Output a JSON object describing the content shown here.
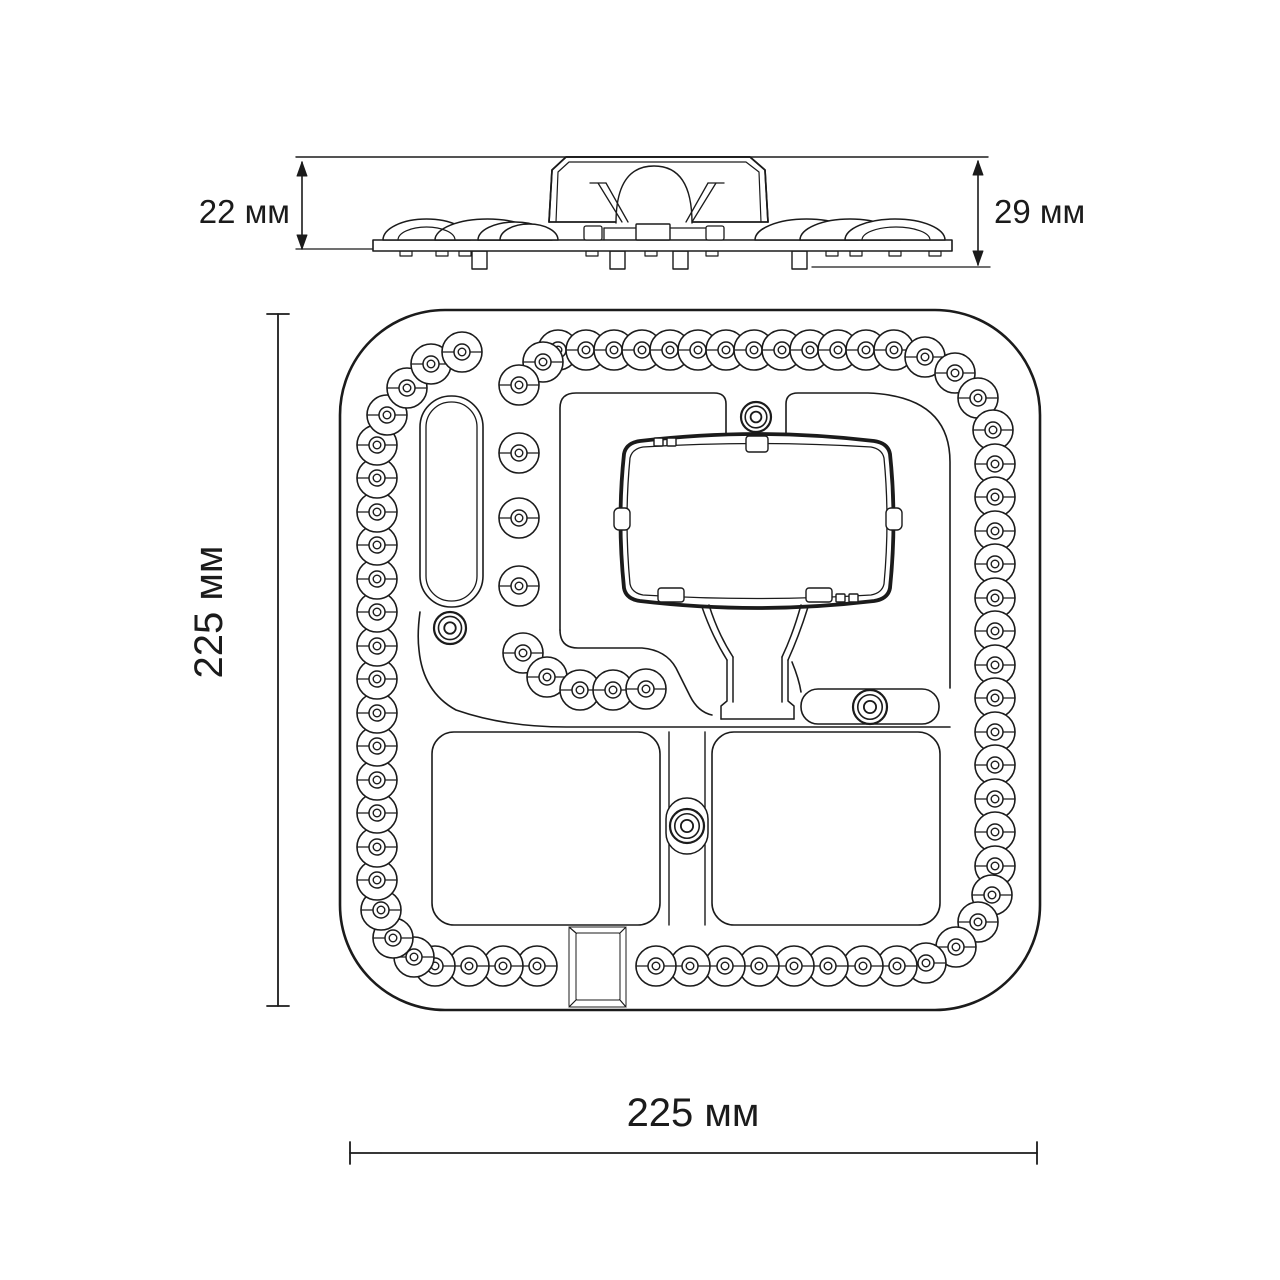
{
  "labels": {
    "side_height_left": "22 мм",
    "side_height_right": "29 мм",
    "plan_height": "225 мм",
    "plan_width": "225 мм"
  },
  "colors": {
    "line": "#1b1b1b",
    "background": "#ffffff"
  },
  "geometry": {
    "canvas": {
      "w": 1280,
      "h": 1280
    },
    "side_view": {
      "ext_top": [
        296,
        157,
        988,
        157
      ],
      "plate": [
        373,
        240,
        579,
        11
      ],
      "dome_base_y": 240,
      "domes": [
        [
          383,
          470,
          21
        ],
        [
          435,
          540,
          21
        ],
        [
          478,
          552,
          18
        ],
        [
          500,
          558,
          16
        ],
        [
          755,
          858,
          21
        ],
        [
          800,
          900,
          21
        ],
        [
          845,
          945,
          21
        ]
      ],
      "dome_details": [
        [
          398,
          455,
          13
        ],
        [
          862,
          930,
          13
        ]
      ],
      "housing_outer": "M 549,222 L 552,170 L 566,157 L 750,157 L 765,170 L 768,222",
      "housing_inner": "M 556,222 L 558,172 L 569,162 L 746,162 L 759,172 L 761,222",
      "housing_dome": "M 616,223 Q 616,166 654,166 Q 692,166 692,223",
      "holder_lines": [
        "M 598,183 L 622,222",
        "M 606,183 L 628,222",
        "M 716,183 L 692,222",
        "M 708,183 L 686,222",
        "M 590,183 L 606,183",
        "M 708,183 L 724,183"
      ],
      "base_box": [
        636,
        224,
        34,
        16
      ],
      "base_lines": [
        "M 604,228 L 636,228",
        "M 670,228 L 710,228",
        "M 604,228 L 604,240",
        "M 710,228 L 710,240"
      ],
      "base_clips": [
        [
          584,
          226,
          18,
          14
        ],
        [
          706,
          226,
          18,
          14
        ]
      ],
      "pins": [
        472,
        610,
        673,
        792
      ],
      "pin": {
        "w": 15,
        "h": 18,
        "y": 251
      },
      "feet": [
        400,
        436,
        459,
        586,
        645,
        706,
        826,
        850,
        889,
        929
      ],
      "foot": {
        "w": 12,
        "h": 5,
        "y": 251
      },
      "dim_left": {
        "x": 302,
        "y1": 162,
        "y2": 249,
        "ext": [
          296,
          249,
          372,
          249
        ],
        "lx": 290,
        "ly": 223
      },
      "dim_right": {
        "x": 978,
        "y1": 161,
        "y2": 265,
        "ext": [
          812,
          267,
          990,
          267
        ],
        "lx": 994,
        "ly": 223
      }
    },
    "top_view": {
      "board": [
        340,
        310,
        700,
        700,
        105
      ],
      "led": {
        "r": 20,
        "ring_r": 8,
        "dot_r": 3.8
      },
      "ring_leds": [
        [
          558,
          350
        ],
        [
          586,
          350
        ],
        [
          614,
          350
        ],
        [
          642,
          350
        ],
        [
          670,
          350
        ],
        [
          698,
          350
        ],
        [
          726,
          350
        ],
        [
          754,
          350
        ],
        [
          782,
          350
        ],
        [
          810,
          350
        ],
        [
          838,
          350
        ],
        [
          866,
          350
        ],
        [
          894,
          350
        ],
        [
          925,
          357
        ],
        [
          955,
          373
        ],
        [
          978,
          398
        ],
        [
          993,
          430
        ],
        [
          995,
          464
        ],
        [
          995,
          497
        ],
        [
          995,
          531
        ],
        [
          995,
          564
        ],
        [
          995,
          598
        ],
        [
          995,
          631
        ],
        [
          995,
          665
        ],
        [
          995,
          698
        ],
        [
          995,
          732
        ],
        [
          995,
          765
        ],
        [
          995,
          799
        ],
        [
          995,
          832
        ],
        [
          995,
          866
        ],
        [
          992,
          895
        ],
        [
          978,
          922
        ],
        [
          956,
          947
        ],
        [
          926,
          963
        ],
        [
          897,
          966
        ],
        [
          863,
          966
        ],
        [
          828,
          966
        ],
        [
          794,
          966
        ],
        [
          759,
          966
        ],
        [
          725,
          966
        ],
        [
          690,
          966
        ],
        [
          656,
          966
        ],
        [
          537,
          966
        ],
        [
          503,
          966
        ],
        [
          469,
          966
        ],
        [
          435,
          966
        ],
        [
          414,
          957
        ],
        [
          393,
          938
        ],
        [
          381,
          910
        ],
        [
          377,
          880
        ],
        [
          377,
          847
        ],
        [
          377,
          813
        ],
        [
          377,
          780
        ],
        [
          377,
          746
        ],
        [
          377,
          713
        ],
        [
          377,
          679
        ],
        [
          377,
          646
        ],
        [
          377,
          612
        ],
        [
          377,
          579
        ],
        [
          377,
          545
        ],
        [
          377,
          512
        ],
        [
          377,
          478
        ],
        [
          377,
          445
        ],
        [
          387,
          415
        ],
        [
          407,
          388
        ],
        [
          431,
          364
        ],
        [
          462,
          352
        ]
      ],
      "inner_leds": [
        [
          543,
          362
        ],
        [
          519,
          385
        ],
        [
          519,
          453
        ],
        [
          519,
          518
        ],
        [
          519,
          586
        ],
        [
          523,
          653
        ],
        [
          547,
          677
        ],
        [
          580,
          690
        ],
        [
          613,
          690
        ],
        [
          646,
          689
        ]
      ],
      "stadium_outer": [
        420,
        396,
        63,
        211,
        31
      ],
      "stadium_inner": [
        426,
        402,
        51,
        199,
        25
      ],
      "island_paths": [
        "M 560,630 L 560,408 Q 560,393 576,393 L 714,393 Q 726,393 726,404 L 726,440",
        "M 726,440 L 786,440",
        "M 748,440 L 748,448 Q 748,452 752,452 L 762,452 Q 766,452 766,448 L 766,440",
        "M 786,440 L 786,404 Q 786,393 798,393 L 868,393 Q 950,396 950,462 L 950,688",
        "M 560,630 Q 560,648 578,648 L 642,648 Q 666,650 676,668 L 690,696 Q 698,712 712,715",
        "M 792,662 Q 799,679 801,692",
        "M 420,612 Q 417,634 419,650 Q 423,692 456,710 Q 505,727 566,727 L 950,727"
      ],
      "bracket_outer": "M 640,441 Q 700,434 757,434 Q 814,434 874,441 Q 888,443 890,454 Q 897,520 890,588 Q 888,599 874,601 Q 814,608 757,608 Q 700,608 640,601 Q 626,599 624,588 Q 617,520 624,454 Q 626,443 640,441 Z",
      "bracket_inner": "M 643,447 Q 757,440 871,447 Q 882,449 884,458 Q 890,520 884,584 Q 882,593 871,595 Q 757,602 643,595 Q 632,593 630,584 Q 624,520 630,458 Q 632,449 643,447 Z",
      "bracket_clips": [
        [
          746,
          436,
          22,
          16,
          3
        ],
        [
          614,
          508,
          16,
          22,
          5
        ],
        [
          886,
          508,
          16,
          22,
          5
        ],
        [
          658,
          588,
          26,
          14,
          3
        ],
        [
          806,
          588,
          26,
          14,
          3
        ],
        [
          654,
          438,
          9,
          8,
          1
        ],
        [
          667,
          438,
          9,
          8,
          1
        ],
        [
          836,
          594,
          9,
          8,
          1
        ],
        [
          849,
          594,
          9,
          8,
          1
        ]
      ],
      "funnel_paths": [
        "M 702,607 Q 712,636 727,660",
        "M 709,605 Q 718,634 733,657",
        "M 808,607 Q 799,636 788,660",
        "M 801,605 Q 793,634 782,657",
        "M 727,660 L 727,701 L 721,706 L 721,719",
        "M 788,660 L 788,701 L 794,706 L 794,719",
        "M 721,719 L 794,719",
        "M 733,657 L 733,702",
        "M 782,657 L 782,702"
      ],
      "slot_right": [
        801,
        689,
        138,
        35,
        17
      ],
      "bottom_islands": [
        [
          432,
          732,
          228,
          193,
          22
        ],
        [
          712,
          732,
          228,
          193,
          22
        ]
      ],
      "channel_lines": [
        [
          669,
          732,
          669,
          925
        ],
        [
          705,
          732,
          705,
          925
        ]
      ],
      "channel_slot": [
        666,
        798,
        42,
        56,
        21
      ],
      "square": {
        "outer": [
          569,
          927,
          57,
          80
        ],
        "inner": [
          576,
          933,
          44,
          67
        ],
        "bevels": [
          "M 569,927 L 576,933",
          "M 626,927 L 620,933",
          "M 569,1007 L 576,1000",
          "M 626,1007 L 620,1000"
        ]
      },
      "screws": [
        [
          756,
          417,
          15
        ],
        [
          450,
          628,
          16
        ],
        [
          870,
          707,
          17
        ],
        [
          687,
          826,
          17
        ]
      ]
    },
    "plan_dims": {
      "v": {
        "x": 278,
        "y1": 314,
        "y2": 1006,
        "tick": 11,
        "lx": 222,
        "ly": 612
      },
      "h": {
        "y": 1153,
        "x1": 350,
        "x2": 1037,
        "tick": 11,
        "lx": 693,
        "ly": 1126
      }
    }
  }
}
